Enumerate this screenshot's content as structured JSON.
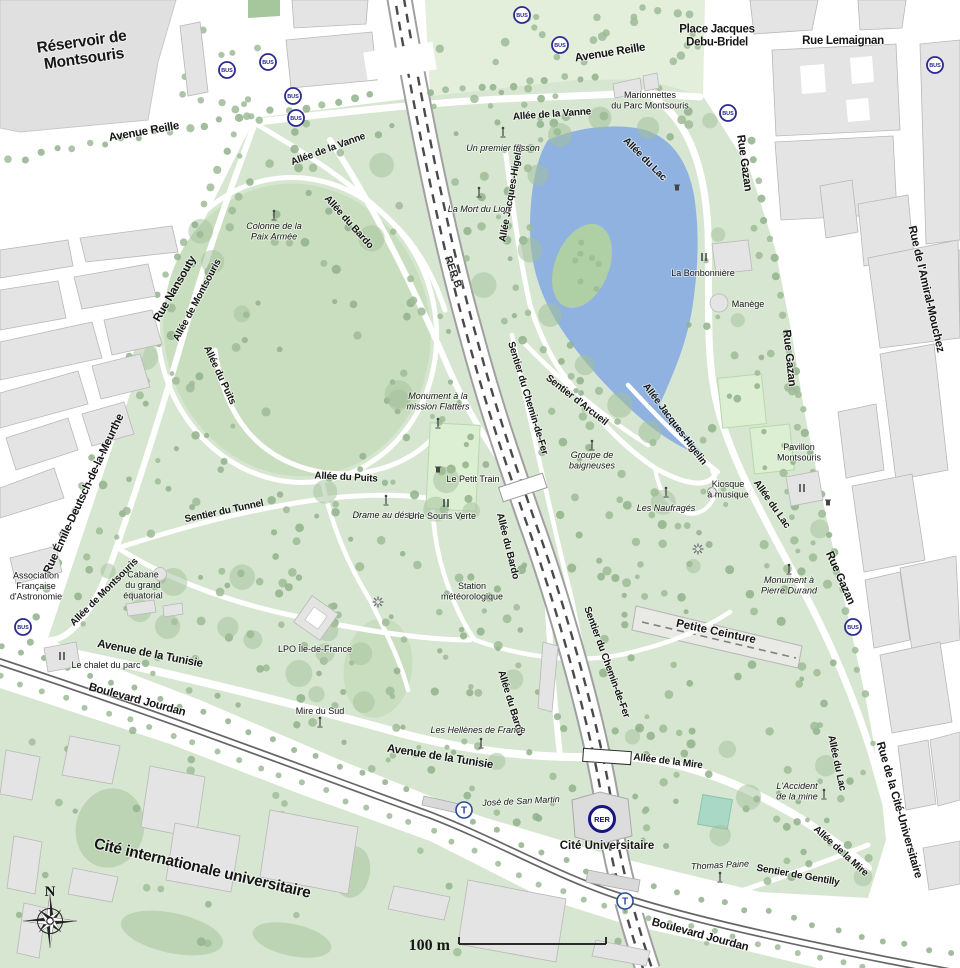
{
  "map": {
    "colors": {
      "park_green": "#d7e6d0",
      "lawn_green": "#c9debf",
      "tree_green": "#9dbb97",
      "tree_green_alt": "#90b28b",
      "cluster_green": "#a3c09b",
      "lake_blue": "#8fb2e1",
      "island_green": "#afd0a4",
      "building_gray": "#e4e4e4",
      "building_stroke": "#b8b8b8",
      "rail_dark": "#4a4a4a",
      "rail_casing": "#a0a0a0",
      "tram_gray": "#666666",
      "transit_blue": "#2a2a90",
      "court_teal": "#a9d9c6",
      "garden_light": "#dcefd2",
      "label_black": "#161616"
    },
    "labels": [
      {
        "t": "Réservoir de\nMontsouris",
        "x": 83,
        "y": 52,
        "r": -8,
        "c": "sb"
      },
      {
        "t": "Avenue Reille",
        "x": 144,
        "y": 132,
        "r": -10,
        "c": "st"
      },
      {
        "t": "Avenue Reille",
        "x": 610,
        "y": 53,
        "r": -9,
        "c": "st"
      },
      {
        "t": "Place Jacques\nDebu-Bridel",
        "x": 717,
        "y": 36,
        "r": 0,
        "c": "st"
      },
      {
        "t": "Rue Lemaignan",
        "x": 843,
        "y": 41,
        "r": 0,
        "c": "st"
      },
      {
        "t": "Rue Gazan",
        "x": 744,
        "y": 163,
        "r": 82,
        "c": "st"
      },
      {
        "t": "Rue Gazan",
        "x": 789,
        "y": 358,
        "r": 84,
        "c": "st"
      },
      {
        "t": "Rue Gazan",
        "x": 840,
        "y": 578,
        "r": 66,
        "c": "st"
      },
      {
        "t": "Rue de l'Amiral-Mouchez",
        "x": 926,
        "y": 289,
        "r": 77,
        "c": "st"
      },
      {
        "t": "Rue Nansouty",
        "x": 175,
        "y": 289,
        "r": -60,
        "c": "st"
      },
      {
        "t": "Rue Émile-Deutsch-de-la-Meurthe",
        "x": 84,
        "y": 494,
        "r": -65,
        "c": "st"
      },
      {
        "t": "Rue de la Cité-Universitaire",
        "x": 899,
        "y": 810,
        "r": 74,
        "c": "st"
      },
      {
        "t": "Boulevard Jourdan",
        "x": 137,
        "y": 700,
        "r": 15,
        "c": "st"
      },
      {
        "t": "Boulevard Jourdan",
        "x": 700,
        "y": 935,
        "r": 15,
        "c": "st"
      },
      {
        "t": "Avenue de la Tunisie",
        "x": 150,
        "y": 654,
        "r": 11,
        "c": "st"
      },
      {
        "t": "Avenue de la Tunisie",
        "x": 440,
        "y": 757,
        "r": 9,
        "c": "st"
      },
      {
        "t": "Cité internationale universitaire",
        "x": 202,
        "y": 870,
        "r": 13,
        "c": "sb"
      },
      {
        "t": "Cité Universitaire",
        "x": 607,
        "y": 846,
        "r": 0,
        "c": "stn"
      },
      {
        "t": "RER B",
        "x": 453,
        "y": 272,
        "r": 70,
        "c": "rb"
      },
      {
        "t": "Allée de la Vanne",
        "x": 328,
        "y": 149,
        "r": -20,
        "c": "pa"
      },
      {
        "t": "Allée de la Vanne",
        "x": 552,
        "y": 114,
        "r": -4,
        "c": "pa"
      },
      {
        "t": "Allée de Montsouris",
        "x": 197,
        "y": 300,
        "r": -62,
        "c": "pa"
      },
      {
        "t": "Allée de Montsouris",
        "x": 104,
        "y": 592,
        "r": -45,
        "c": "pa"
      },
      {
        "t": "Allée du Bardo",
        "x": 349,
        "y": 222,
        "r": 48,
        "c": "pa"
      },
      {
        "t": "Allée du Bardo",
        "x": 508,
        "y": 546,
        "r": 76,
        "c": "pa"
      },
      {
        "t": "Allée du Bardo",
        "x": 511,
        "y": 703,
        "r": 73,
        "c": "pa"
      },
      {
        "t": "Allée du Puits",
        "x": 220,
        "y": 375,
        "r": 65,
        "c": "pa"
      },
      {
        "t": "Allée du Puits",
        "x": 346,
        "y": 477,
        "r": 3,
        "c": "pa"
      },
      {
        "t": "Allée du Lac",
        "x": 645,
        "y": 159,
        "r": 45,
        "c": "pa"
      },
      {
        "t": "Allée du Lac",
        "x": 772,
        "y": 504,
        "r": 55,
        "c": "pa"
      },
      {
        "t": "Allée du Lac",
        "x": 837,
        "y": 763,
        "r": 78,
        "c": "pa"
      },
      {
        "t": "Allée Jacques-Higelin",
        "x": 511,
        "y": 193,
        "r": -80,
        "c": "pa"
      },
      {
        "t": "Allée Jacques-Higelin",
        "x": 675,
        "y": 424,
        "r": 53,
        "c": "pa"
      },
      {
        "t": "Allée de la Mire",
        "x": 668,
        "y": 761,
        "r": 7,
        "c": "pa"
      },
      {
        "t": "Allée de la Mire",
        "x": 841,
        "y": 851,
        "r": 42,
        "c": "pa"
      },
      {
        "t": "Sentier du Tunnel",
        "x": 224,
        "y": 511,
        "r": -12,
        "c": "pa"
      },
      {
        "t": "Sentier du Chemin-de-Fer",
        "x": 528,
        "y": 398,
        "r": 73,
        "c": "pa"
      },
      {
        "t": "Sentier du Chemin-de-Fer",
        "x": 607,
        "y": 662,
        "r": 70,
        "c": "pa"
      },
      {
        "t": "Sentier d'Arcueil",
        "x": 577,
        "y": 400,
        "r": 38,
        "c": "pa"
      },
      {
        "t": "Sentier de Gentilly",
        "x": 798,
        "y": 875,
        "r": 10,
        "c": "pa"
      },
      {
        "t": "Petite Ceinture",
        "x": 716,
        "y": 632,
        "r": 12,
        "c": "pa2"
      },
      {
        "t": "Marionnettes\ndu Parc Montsouris",
        "x": 650,
        "y": 100,
        "r": 0,
        "c": "po"
      },
      {
        "t": "Un premier frisson",
        "x": 503,
        "y": 148,
        "r": 0,
        "c": "pi"
      },
      {
        "t": "La Mort du Lion",
        "x": 479,
        "y": 209,
        "r": 0,
        "c": "pi"
      },
      {
        "t": "Colonne de la\nPaix Armée",
        "x": 274,
        "y": 231,
        "r": 0,
        "c": "pi"
      },
      {
        "t": "La Bonbonnière",
        "x": 703,
        "y": 273,
        "r": 0,
        "c": "po"
      },
      {
        "t": "Manège",
        "x": 748,
        "y": 304,
        "r": 0,
        "c": "po"
      },
      {
        "t": "Monument à la\nmission Flatters",
        "x": 438,
        "y": 401,
        "r": 0,
        "c": "pi"
      },
      {
        "t": "Le Petit Train",
        "x": 473,
        "y": 479,
        "r": 0,
        "c": "po"
      },
      {
        "t": "Groupe de\nbaigneuses",
        "x": 592,
        "y": 460,
        "r": 0,
        "c": "pi"
      },
      {
        "t": "Drame au désert",
        "x": 386,
        "y": 515,
        "r": 0,
        "c": "pi"
      },
      {
        "t": "Une Souris Verte",
        "x": 442,
        "y": 516,
        "r": 0,
        "c": "po"
      },
      {
        "t": "Les Naufragés",
        "x": 666,
        "y": 508,
        "r": 0,
        "c": "pi"
      },
      {
        "t": "Kiosque\nà musique",
        "x": 728,
        "y": 489,
        "r": 0,
        "c": "po"
      },
      {
        "t": "Monument à\nPierre Durand",
        "x": 789,
        "y": 585,
        "r": 0,
        "c": "pi"
      },
      {
        "t": "Pavillon\nMontsouris",
        "x": 799,
        "y": 452,
        "r": 0,
        "c": "po"
      },
      {
        "t": "Station\nmétéorologique",
        "x": 472,
        "y": 591,
        "r": 0,
        "c": "po"
      },
      {
        "t": "Cabane\ndu grand\néquatorial",
        "x": 143,
        "y": 585,
        "r": 0,
        "c": "po"
      },
      {
        "t": "Association\nFrançaise\nd'Astronomie",
        "x": 36,
        "y": 586,
        "r": 0,
        "c": "po"
      },
      {
        "t": "Le chalet du parc",
        "x": 106,
        "y": 665,
        "r": 0,
        "c": "po"
      },
      {
        "t": "LPO Île-de-France",
        "x": 315,
        "y": 649,
        "r": 0,
        "c": "po"
      },
      {
        "t": "Mire du Sud",
        "x": 320,
        "y": 711,
        "r": 0,
        "c": "po"
      },
      {
        "t": "Les Hellènes de France",
        "x": 478,
        "y": 730,
        "r": 0,
        "c": "pi"
      },
      {
        "t": "José de San Martin",
        "x": 521,
        "y": 801,
        "r": -3,
        "c": "pi"
      },
      {
        "t": "L'Accident\nde la mine",
        "x": 797,
        "y": 791,
        "r": 0,
        "c": "pi"
      },
      {
        "t": "Thomas Paine",
        "x": 720,
        "y": 865,
        "r": -3,
        "c": "pi"
      }
    ],
    "transit": {
      "bus_label": "BUS",
      "tram_label": "T",
      "rer_label": "RER",
      "bus_stops": [
        [
          227,
          70
        ],
        [
          268,
          62
        ],
        [
          293,
          96
        ],
        [
          296,
          118
        ],
        [
          522,
          15
        ],
        [
          560,
          45
        ],
        [
          728,
          113
        ],
        [
          935,
          65
        ],
        [
          23,
          627
        ],
        [
          853,
          627
        ]
      ],
      "tram_stops": [
        [
          464,
          810
        ],
        [
          625,
          901
        ]
      ],
      "rer_stations": [
        [
          602,
          819
        ]
      ]
    },
    "poi_icons": {
      "restaurants": [
        [
          62,
          656
        ],
        [
          704,
          257
        ],
        [
          802,
          488
        ],
        [
          446,
          503
        ]
      ],
      "monuments": [
        [
          274,
          216
        ],
        [
          503,
          133
        ],
        [
          479,
          193
        ],
        [
          438,
          424
        ],
        [
          592,
          446
        ],
        [
          386,
          501
        ],
        [
          666,
          493
        ],
        [
          789,
          570
        ],
        [
          320,
          723
        ],
        [
          481,
          744
        ],
        [
          720,
          878
        ],
        [
          824,
          795
        ]
      ],
      "flowerbeds": [
        [
          378,
          602
        ],
        [
          698,
          549
        ]
      ],
      "trash_bins": [
        [
          677,
          188
        ],
        [
          828,
          503
        ],
        [
          438,
          470
        ]
      ]
    },
    "scale": {
      "label": "100 m",
      "x1": 459,
      "x2": 606,
      "y": 944
    },
    "compass": {
      "label": "N",
      "cx": 50,
      "cy": 921,
      "r": 27
    }
  }
}
